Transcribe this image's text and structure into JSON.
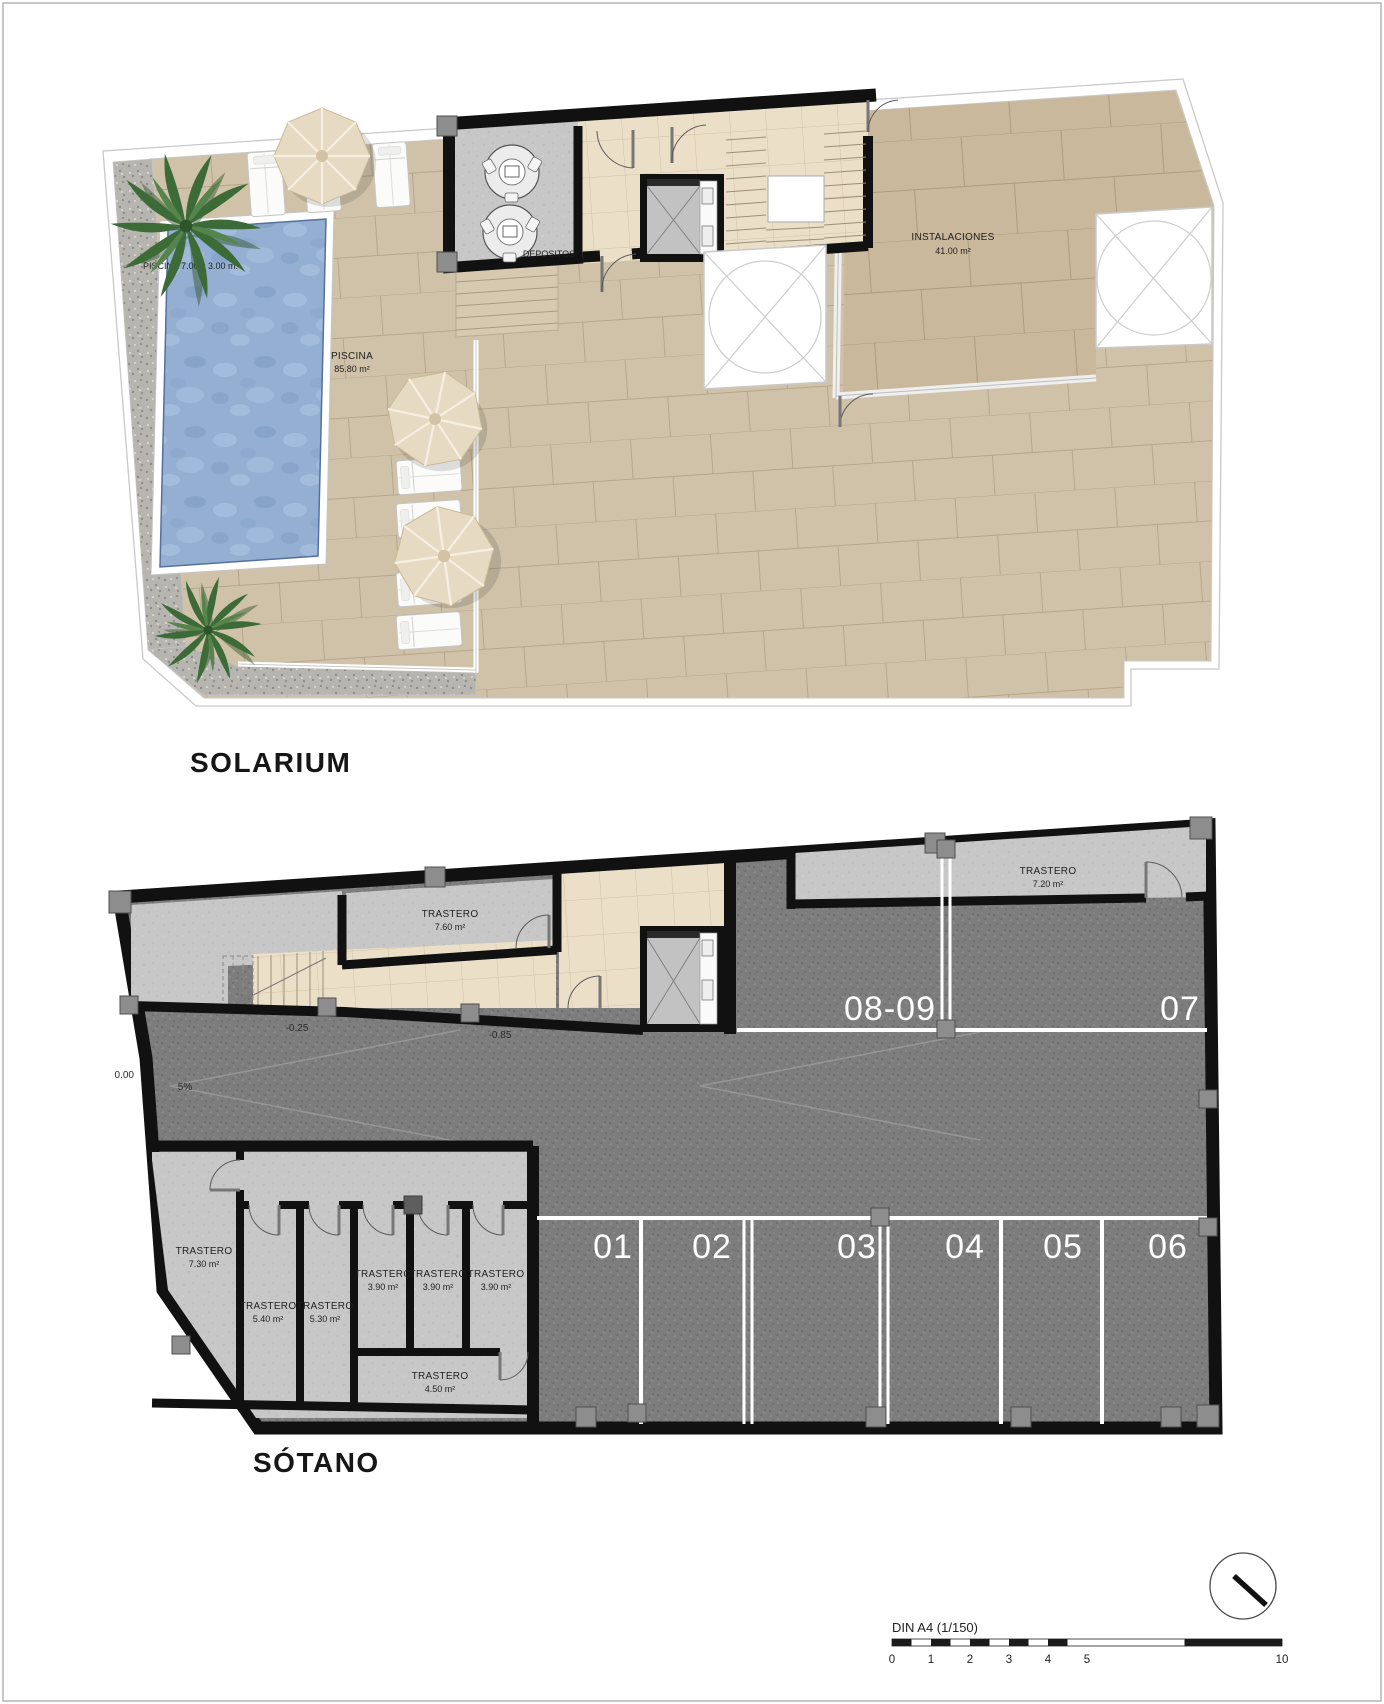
{
  "palette": {
    "wall": "#111111",
    "terrace_tile": "#cfc2a8",
    "instalaciones_tile": "#c9b89b",
    "corridor_tile": "#ebdfc7",
    "asphalt": "#7d7d7d",
    "room_gray": "#c7c7c7",
    "gravel": "#b7b5b0",
    "pool_water": "#94afd2",
    "parking_line": "#ffffff"
  },
  "solarium": {
    "title": "SOLARIUM",
    "pool_dim": "PISCINA 7.00 x 3.00 m.",
    "pool_name": "PISCINA",
    "pool_area": "85.80 m²",
    "depositos": "DEPOSITOS",
    "instalaciones": "INSTALACIONES",
    "instalaciones_area": "41.00 m²"
  },
  "sotano": {
    "title": "SÓTANO",
    "level_zero": "0.00",
    "level_ramp_mid": "-0.25",
    "level_ramp_low": "-0.85",
    "ramp_slope": "5%",
    "parking": [
      "01",
      "02",
      "03",
      "04",
      "05",
      "06",
      "07",
      "08-09"
    ],
    "trasteros": {
      "t760": {
        "label": "TRASTERO",
        "area": "7.60 m²"
      },
      "t720": {
        "label": "TRASTERO",
        "area": "7.20 m²"
      },
      "t730": {
        "label": "TRASTERO",
        "area": "7.30 m²"
      },
      "t540": {
        "label": "TRASTERO",
        "area": "5.40 m²"
      },
      "t530": {
        "label": "TRASTERO",
        "area": "5.30 m²"
      },
      "t390a": {
        "label": "TRASTERO",
        "area": "3.90 m²"
      },
      "t390b": {
        "label": "TRASTERO",
        "area": "3.90 m²"
      },
      "t390c": {
        "label": "TRASTERO",
        "area": "3.90 m²"
      },
      "t450": {
        "label": "TRASTERO",
        "area": "4.50 m²"
      }
    }
  },
  "scale_bar": {
    "title": "DIN A4 (1/150)",
    "ticks": [
      "0",
      "1",
      "2",
      "3",
      "4",
      "5",
      "10"
    ]
  }
}
